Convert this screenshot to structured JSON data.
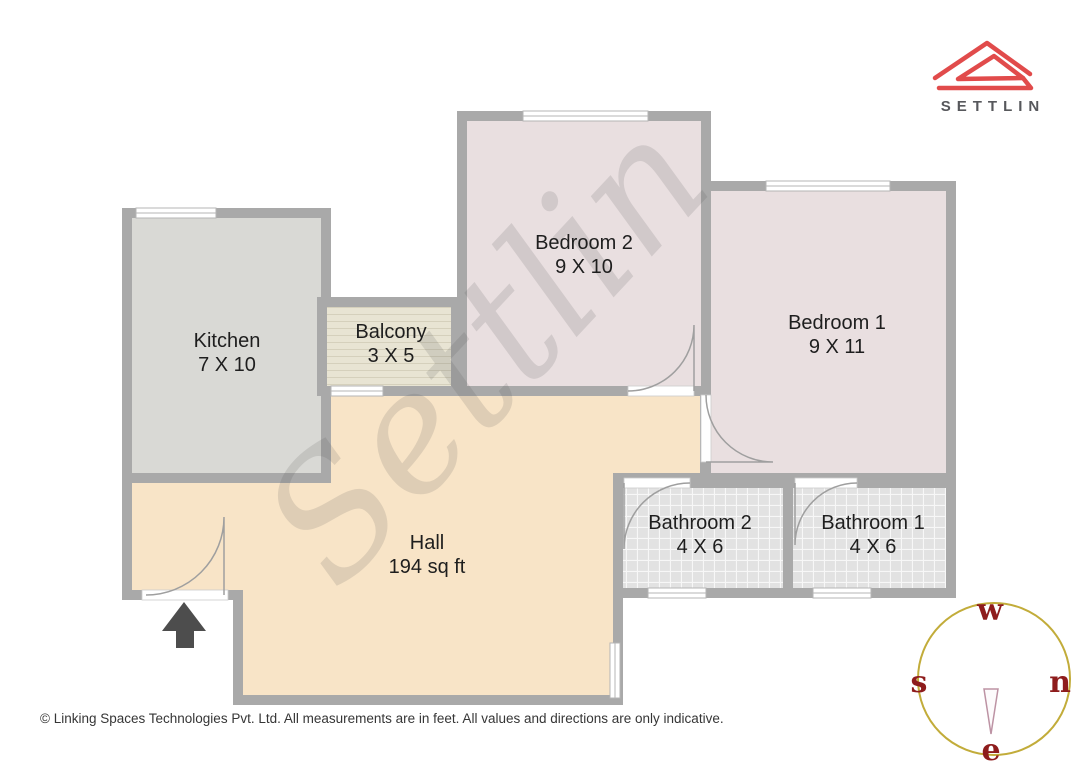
{
  "plan": {
    "wall_color": "#a9a9a9",
    "watermark": "Settlin",
    "rooms": [
      {
        "id": "kitchen",
        "name": "Kitchen",
        "dims": "7 X 10",
        "color": "#d9d9d5"
      },
      {
        "id": "balcony",
        "name": "Balcony",
        "dims": "3 X 5",
        "color": "#e8e4d3"
      },
      {
        "id": "bedroom2",
        "name": "Bedroom 2",
        "dims": "9 X 10",
        "color": "#e9dfe0"
      },
      {
        "id": "bedroom1",
        "name": "Bedroom 1",
        "dims": "9 X 11",
        "color": "#e9dfe0"
      },
      {
        "id": "bathroom2",
        "name": "Bathroom 2",
        "dims": "4 X 6",
        "color": "#e2e2e2"
      },
      {
        "id": "bathroom1",
        "name": "Bathroom 1",
        "dims": "4 X 6",
        "color": "#e2e2e2"
      },
      {
        "id": "hall",
        "name": "Hall",
        "dims": "194 sq ft",
        "color": "#f8e4c7"
      }
    ]
  },
  "brand": {
    "name": "SETTLIN",
    "accent": "#e14b4b"
  },
  "compass": {
    "top": "w",
    "left": "s",
    "right": "n",
    "bottom": "e",
    "ring_color": "#c2ac3a",
    "letter_color": "#8e1c1c"
  },
  "footer": {
    "text": "© Linking Spaces Technologies Pvt. Ltd. All measurements are in feet. All values and directions are only indicative."
  }
}
